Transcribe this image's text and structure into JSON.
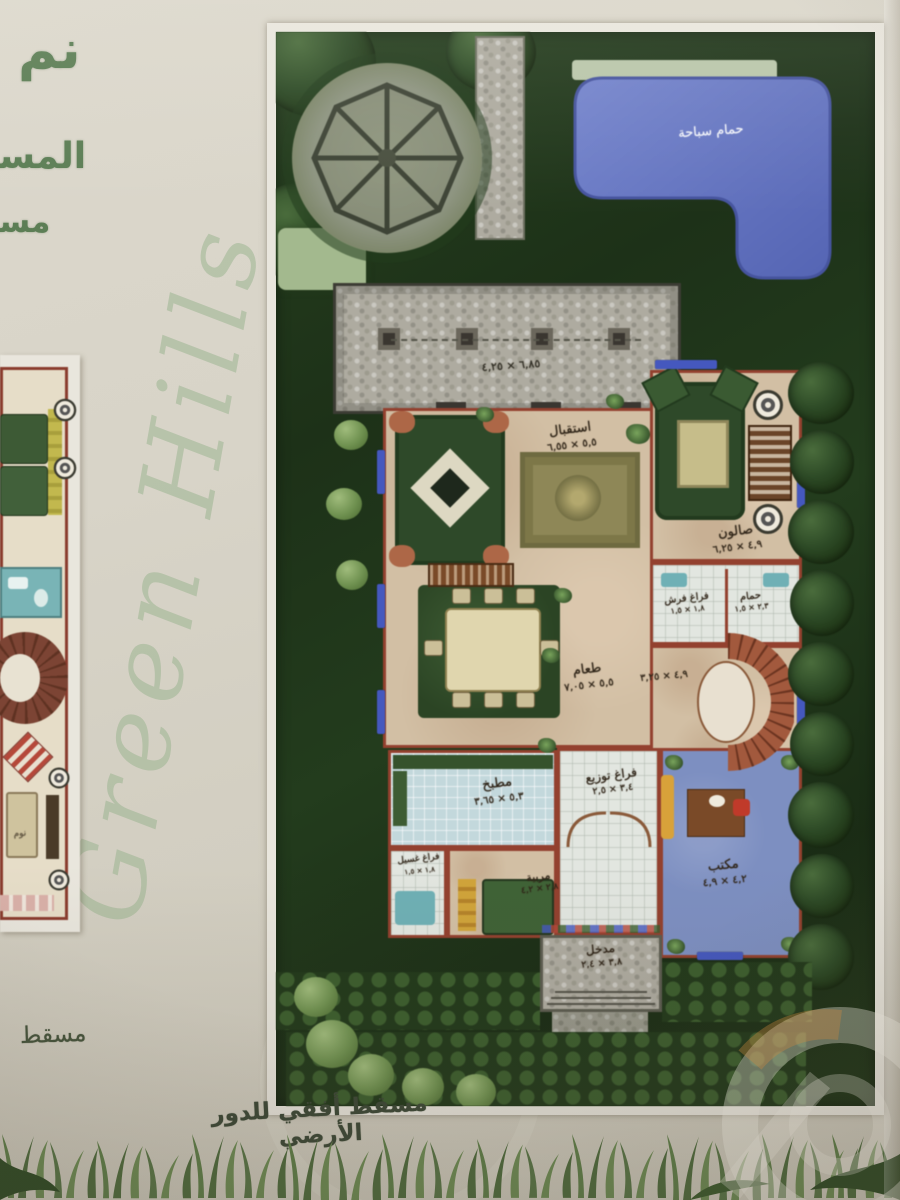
{
  "header": {
    "big_text": "نم",
    "partial_line1": "المسا",
    "partial_line2": "مسا"
  },
  "script_watermark": "Green Hills",
  "captions": {
    "left_plan_partial": "مسقط",
    "main_plan": "مسقط أفقي للدور الأرضي"
  },
  "pool_label": "حمام سباحة",
  "terrace_dims": "٦,٨٥ × ٤,٢٥",
  "stair_hall_dims": "٤,٩ × ٣,٢٥",
  "rooms": [
    {
      "name": "استقبال",
      "dims": "٥,٥ × ٦,٥٥"
    },
    {
      "name": "صالون",
      "dims": "٤,٩ × ٦,٢٥"
    },
    {
      "name": "طعام",
      "dims": "٥,٥ × ٧,٠٥"
    },
    {
      "name": "حمام",
      "dims": "٢,٣ × ١,٥"
    },
    {
      "name": "فراغ فرش",
      "dims": "١,٨ × ١,٥"
    },
    {
      "name": "مطبخ",
      "dims": "٥,٣ × ٣,٦٥"
    },
    {
      "name": "فراغ توزيع",
      "dims": "٣,٤ × ٢,٥"
    },
    {
      "name": "مربية",
      "dims": "٢,٨ × ٤,٢"
    },
    {
      "name": "مكتب",
      "dims": "٤,٢ × ٤,٩"
    },
    {
      "name": "مدخل",
      "dims": "٣,٨ × ٢,٤"
    },
    {
      "name": "فراغ غسيل",
      "dims": "١,٨ × ١,٥"
    },
    {
      "name": "نوم",
      "dims": ""
    }
  ],
  "colors": {
    "pool": "#6677c6",
    "garden_dark": "#1d3118",
    "wall": "#93412f",
    "frame": "#e9e6dd",
    "header_green": "#5c7e55"
  }
}
